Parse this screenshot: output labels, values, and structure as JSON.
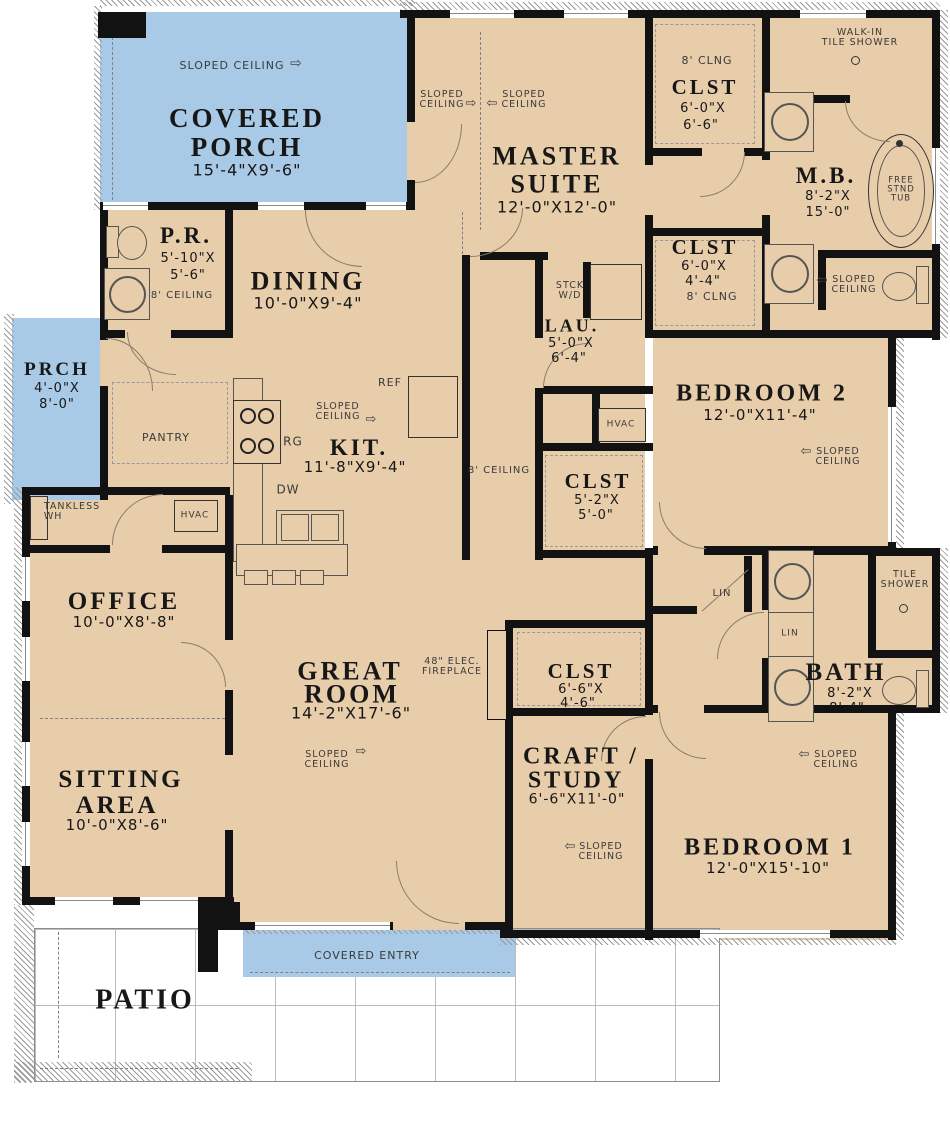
{
  "colors": {
    "floor": "#e8cdab",
    "porch_blue": "#a8cae6",
    "wall": "#121212",
    "patio_line": "#bcbcbc"
  },
  "icons": {
    "arrow_right": "⇨",
    "arrow_left": "⇦"
  },
  "rooms": {
    "covered_porch": {
      "name1": "COVERED",
      "name2": "PORCH",
      "dims": "15'-4\"X9'-6\""
    },
    "prch": {
      "name": "PRCH",
      "dims1": "4'-0\"X",
      "dims2": "8'-0\""
    },
    "pr": {
      "name": "P.R.",
      "dims1": "5'-10\"X",
      "dims2": "5'-6\""
    },
    "dining": {
      "name": "DINING",
      "dims": "10'-0\"X9'-4\""
    },
    "master": {
      "name1": "MASTER",
      "name2": "SUITE",
      "dims": "12'-0\"X12'-0\""
    },
    "clst_master1": {
      "name": "CLST",
      "dims1": "6'-0\"X",
      "dims2": "6'-6\""
    },
    "mb": {
      "name": "M.B.",
      "dims1": "8'-2\"X",
      "dims2": "15'-0\""
    },
    "clst_master2": {
      "name": "CLST",
      "dims1": "6'-0\"X",
      "dims2": "4'-4\""
    },
    "lau": {
      "name": "LAU.",
      "dims1": "5'-0\"X",
      "dims2": "6'-4\""
    },
    "bedroom2": {
      "name": "BEDROOM 2",
      "dims": "12'-0\"X11'-4\""
    },
    "kit": {
      "name": "KIT.",
      "dims": "11'-8\"X9'-4\""
    },
    "clst_hall": {
      "name": "CLST",
      "dims1": "5'-2\"X",
      "dims2": "5'-0\""
    },
    "office": {
      "name": "OFFICE",
      "dims": "10'-0\"X8'-8\""
    },
    "great": {
      "name1": "GREAT",
      "name2": "ROOM",
      "dims": "14'-2\"X17'-6\""
    },
    "clst_craft": {
      "name": "CLST",
      "dims1": "6'-6\"X",
      "dims2": "4'-6\""
    },
    "bath": {
      "name": "BATH",
      "dims1": "8'-2\"X",
      "dims2": "8'-4\""
    },
    "sitting": {
      "name1": "SITTING",
      "name2": "AREA",
      "dims": "10'-0\"X8'-6\""
    },
    "craft": {
      "name1": "CRAFT /",
      "name2": "STUDY",
      "dims": "6'-6\"X11'-0\""
    },
    "bedroom1": {
      "name": "BEDROOM 1",
      "dims": "12'-0\"X15'-10\""
    },
    "patio": {
      "name": "PATIO"
    },
    "entry": {
      "name": "COVERED ENTRY"
    }
  },
  "ann": {
    "sloped1": "SLOPED",
    "sloped2": "CEILING",
    "ceiling8": "8' CEILING",
    "clng8": "8' CLNG",
    "walkin1": "WALK-IN",
    "walkin2": "TILE SHOWER",
    "tile1": "TILE",
    "tile2": "SHOWER",
    "tub1": "FREE",
    "tub2": "STND",
    "tub3": "TUB",
    "stck1": "STCK",
    "stck2": "W/D",
    "pantry": "PANTRY",
    "ref": "REF",
    "rg": "RG",
    "dw": "DW",
    "hvac": "HVAC",
    "tankless1": "TANKLESS",
    "tankless2": "WH",
    "lin": "LIN",
    "fp1": "48\" ELEC.",
    "fp2": "FIREPLACE"
  }
}
